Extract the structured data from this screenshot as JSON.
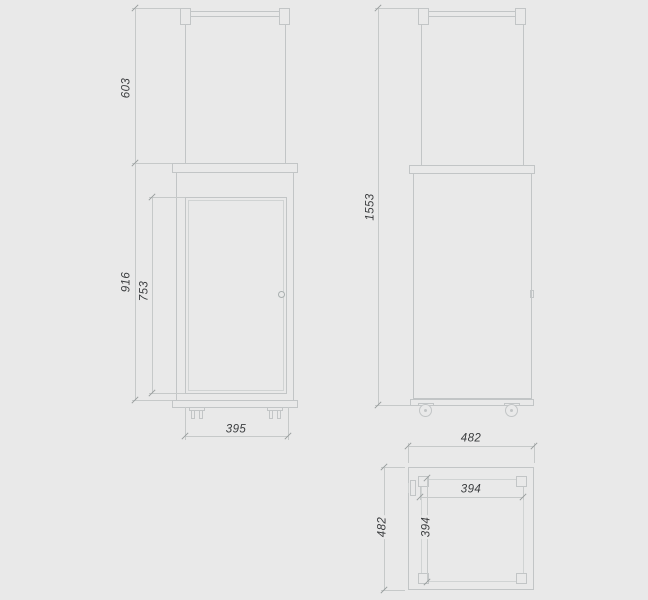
{
  "drawing": {
    "type": "technical-orthographic-drawing",
    "subject": "patio-heater-cabinet-with-glass-tube-and-casters",
    "background": "#e9e9e9",
    "line_color": "#c2c5c6",
    "dim_line_color": "#c6c9c9",
    "text_color": "#3a3c3e",
    "views": {
      "front": {
        "label": "front-view",
        "dims": {
          "glass_section_height": "603",
          "body_height": "916",
          "door_height": "753",
          "width": "395"
        }
      },
      "side": {
        "label": "side-view",
        "dims": {
          "total_height": "1553"
        }
      },
      "top": {
        "label": "top-view",
        "dims": {
          "outer_width": "482",
          "outer_depth": "482",
          "inner_width": "394",
          "inner_depth": "394"
        }
      }
    }
  }
}
